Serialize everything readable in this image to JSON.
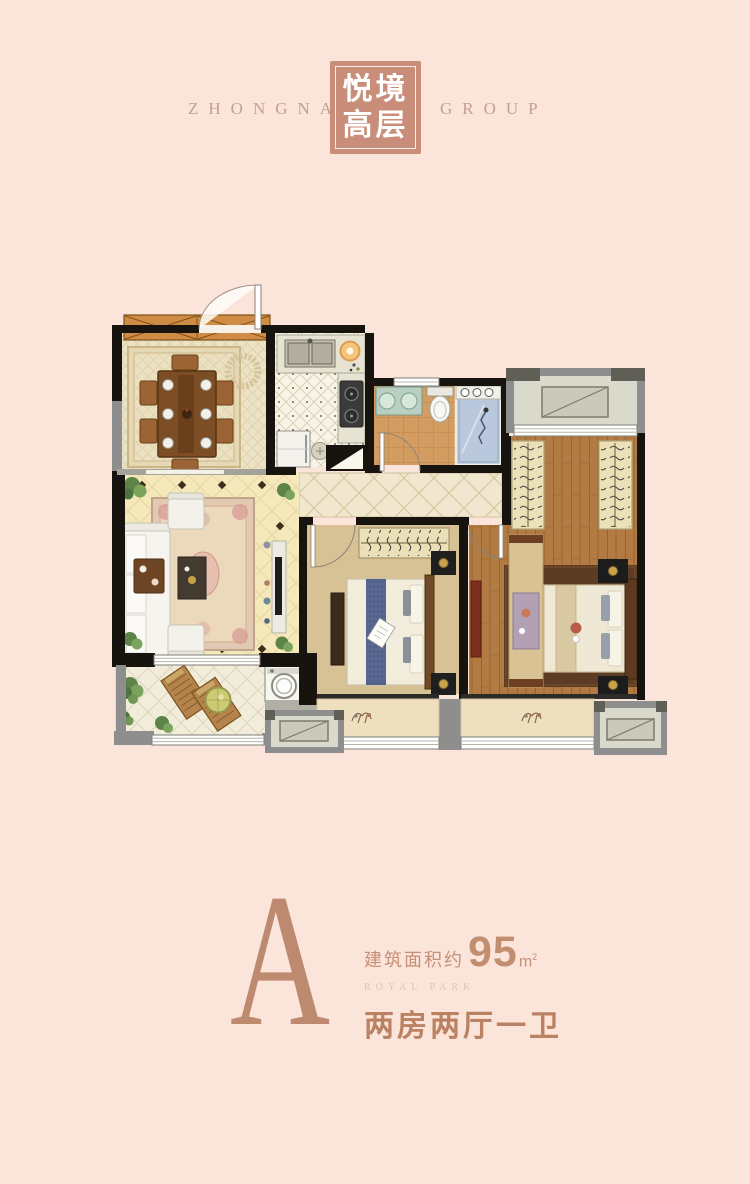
{
  "page": {
    "background_color": "#fbe5da"
  },
  "header": {
    "brand_left": "ZHONGNA",
    "brand_right": "GROUP",
    "badge": {
      "line1": "悦境",
      "line2": "高层",
      "background_color": "#c98e79",
      "text_color": "#ffffff"
    }
  },
  "floor_plan": {
    "colors": {
      "wall_black": "#17140f",
      "wall_gray": "#8e8e8e",
      "wood_floor": "#b17b43",
      "bath_tile": "#d39c60",
      "living_floor": "#f5e8ba",
      "shower_glass": "#b9c8dc",
      "ac_platform": "#dadacc"
    },
    "regions": [
      "dining-room",
      "kitchen",
      "bathroom",
      "hallway",
      "living-room",
      "bedroom",
      "master-bedroom",
      "walk-in-closet",
      "balcony",
      "ac-platform",
      "bay-window"
    ]
  },
  "unit": {
    "letter": "A",
    "area_label": "建筑面积约",
    "area_value": "95",
    "area_unit": "m",
    "area_unit_sup": "2",
    "series_label": "ROYAL PARK",
    "layout_label": "两房两厅一卫",
    "accent_color": "#bd8a70"
  }
}
